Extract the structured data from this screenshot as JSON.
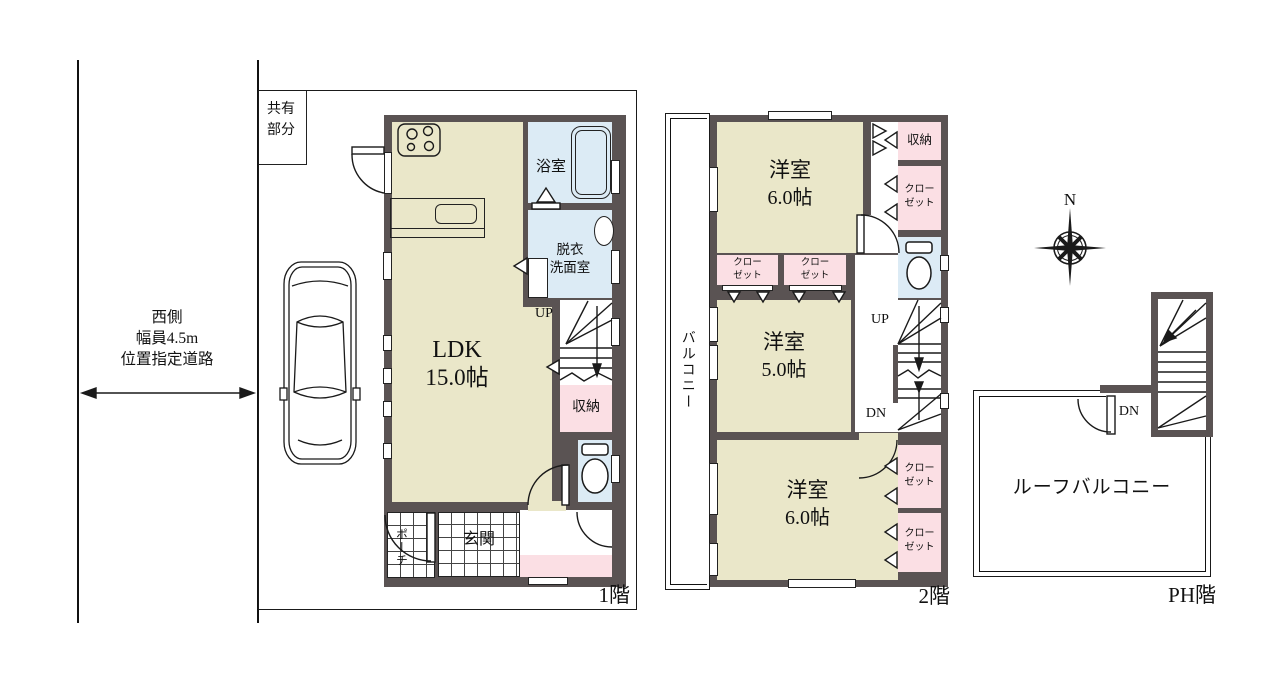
{
  "colors": {
    "wall": "#5a5353",
    "room": "#eae7c9",
    "closet": "#fbdfe4",
    "wet": "#dcebf5",
    "line": "#1a1a1a"
  },
  "road": {
    "side": "西側",
    "width": "幅員4.5m",
    "type": "位置指定道路"
  },
  "floor1": {
    "label": "1階",
    "shared": "共有部分",
    "garage": "車庫",
    "ldk_name": "LDK",
    "ldk_size": "15.0帖",
    "bath": "浴室",
    "washroom_line1": "脱衣",
    "washroom_line2": "洗面室",
    "up": "UP",
    "storage": "収納",
    "entrance": "玄関",
    "porch": "ポーチ"
  },
  "floor2": {
    "label": "2階",
    "balcony": "バルコニー",
    "room_north_name": "洋室",
    "room_north_size": "6.0帖",
    "room_middle_name": "洋室",
    "room_middle_size": "5.0帖",
    "room_south_name": "洋室",
    "room_south_size": "6.0帖",
    "storage": "収納",
    "closet_line1": "クロー",
    "closet_line2": "ゼット",
    "up": "UP",
    "dn": "DN"
  },
  "floorPH": {
    "label": "PH階",
    "roof_balcony": "ルーフバルコニー",
    "dn": "DN"
  },
  "compass": {
    "north": "N"
  }
}
